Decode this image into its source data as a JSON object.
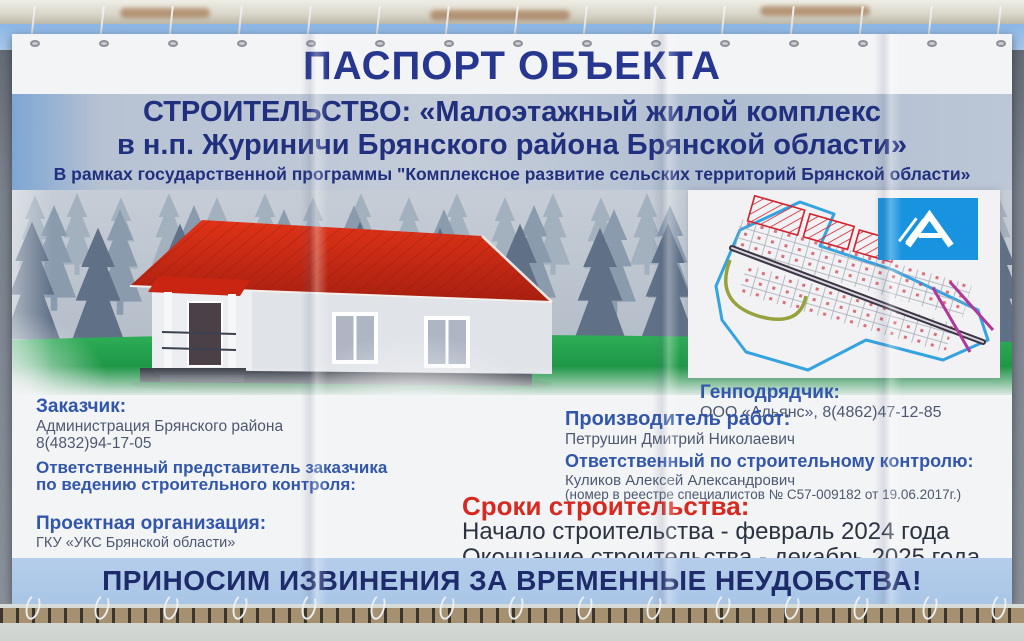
{
  "banner": {
    "title": "ПАСПОРТ ОБЪЕКТА",
    "subtitle_line1": "СТРОИТЕЛЬСТВО: «Малоэтажный жилой комплекс",
    "subtitle_line2": "в н.п. Журиничи Брянского района Брянской области»",
    "program_line": "В рамках государственной программы \"Комплексное развитие сельских территорий Брянской области»",
    "apology_line": "ПРИНОСИМ ИЗВИНЕНИЯ ЗА ВРЕМЕННЫЕ НЕУДОБСТВА!"
  },
  "left_column": {
    "customer_label": "Заказчик:",
    "customer_name": "Администрация Брянского района",
    "customer_phone": "8(4832)94-17-05",
    "representative_line1": "Ответственный представитель заказчика",
    "representative_line2": "по ведению строительного контроля:",
    "design_org_label": "Проектная организация:",
    "design_org_name": "ГКУ «УКС Брянской области»"
  },
  "right_column": {
    "contractor_label": "Генподрядчик:",
    "contractor_value": "ООО «Альянс», 8(4862)47-12-85",
    "works_manager_label": "Производитель работ:",
    "works_manager_name": "Петрушин Дмитрий Николаевич",
    "control_label": "Ответственный по строительному контролю:",
    "control_name": "Куликов Алексей Александрович",
    "control_registry": "(номер в реестре специалистов № С57-009182 от 19.06.2017г.)"
  },
  "schedule": {
    "label": "Сроки строительства:",
    "start_line": "Начало строительства - февраль 2024 года",
    "end_line": "Окончание строительства - декабрь 2025 года"
  },
  "icons": {
    "logo": "alliance-logo-stylized-A",
    "map": "site-plan-drawing",
    "illustration": "house-with-red-roof-in-forest"
  },
  "colors": {
    "title_navy": "#27368f",
    "subtitle_navy": "#20307e",
    "label_blue": "#3156ab",
    "body_text": "#4e586e",
    "schedule_red": "#d62920",
    "schedule_text": "#2c3340",
    "apology_navy": "#1d2b6b",
    "apology_bg": "#a9c6e7",
    "band_bg": "#b7c2d3",
    "logo_blue": "#1793df",
    "roof_red": "#cc2412",
    "grass_green": "#17a048",
    "banner_white": "#f3f4f6"
  }
}
